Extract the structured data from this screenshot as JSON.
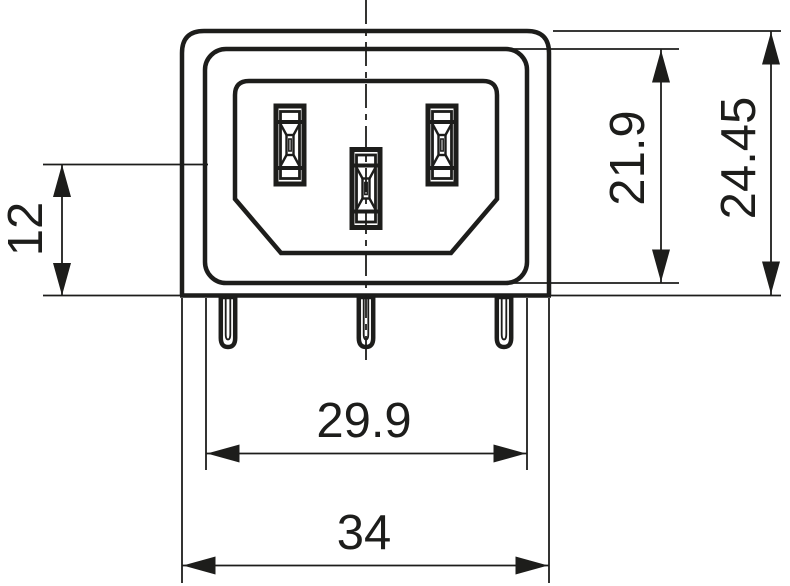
{
  "drawing": {
    "background_color": "#ffffff",
    "line_color": "#1d1d1b",
    "dimensions": {
      "d12": {
        "label": "12"
      },
      "d21_9": {
        "label": "21.9"
      },
      "d24_45": {
        "label": "24.45"
      },
      "d29_9": {
        "label": "29.9"
      },
      "d34": {
        "label": "34"
      }
    }
  }
}
